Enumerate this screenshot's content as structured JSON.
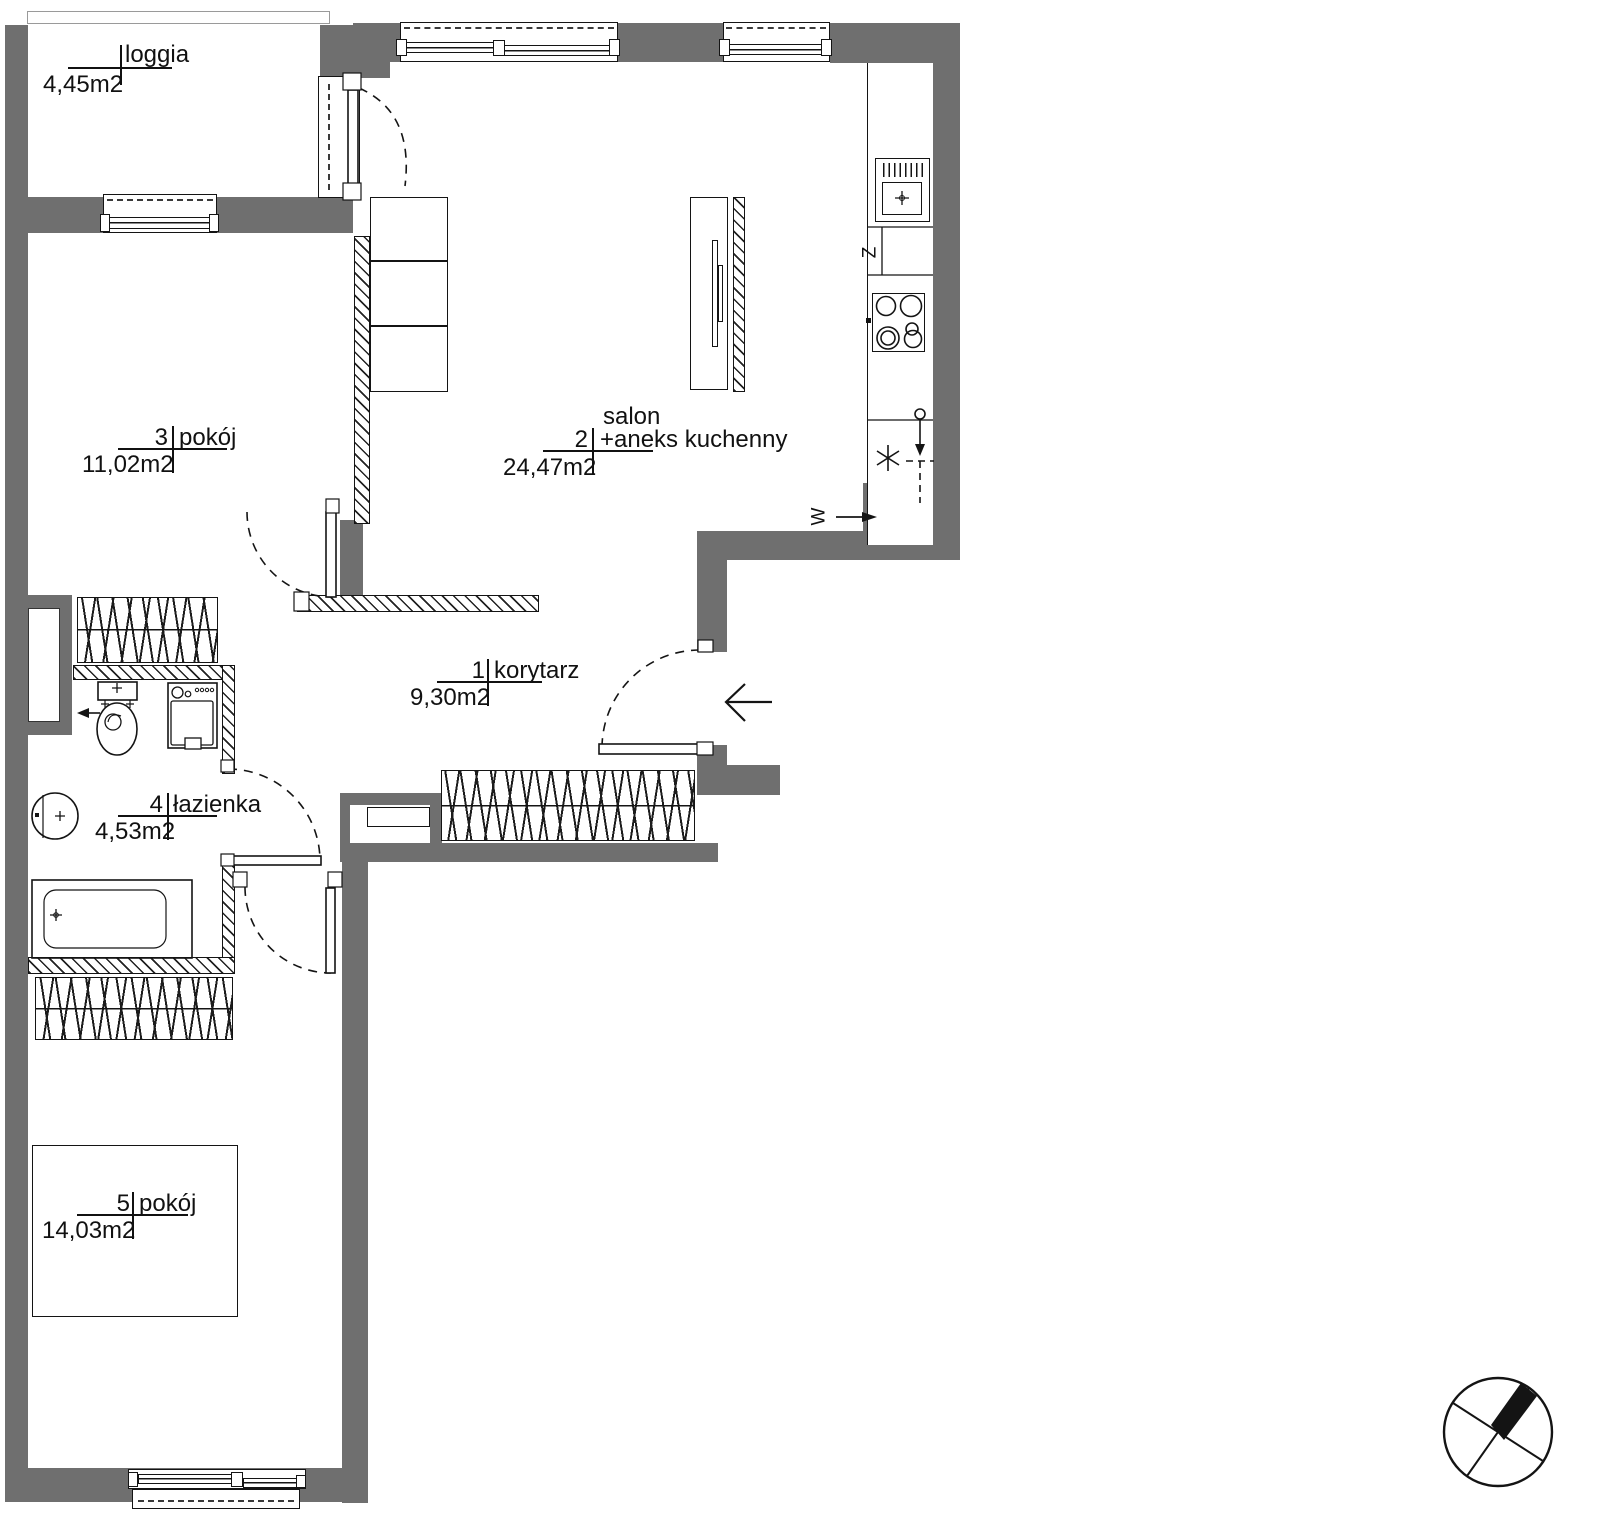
{
  "title": "apartment floor plan",
  "rooms": [
    {
      "number": "",
      "name": "loggia",
      "area": "4,45m2"
    },
    {
      "number": "1",
      "name": "korytarz",
      "area": "9,30m2"
    },
    {
      "number": "2",
      "name_top": "salon",
      "name": "+aneks kuchenny",
      "area": "24,47m2"
    },
    {
      "number": "3",
      "name": "pokój",
      "area": "11,02m2"
    },
    {
      "number": "4",
      "name": "łazienka",
      "area": "4,53m2"
    },
    {
      "number": "5",
      "name": "pokój",
      "area": "14,03m2"
    }
  ],
  "symbols": {
    "dishwasher": "Z",
    "ventilation": "W"
  },
  "colors": {
    "wall": "#6f6f6f",
    "line": "#141414",
    "background": "#ffffff"
  }
}
